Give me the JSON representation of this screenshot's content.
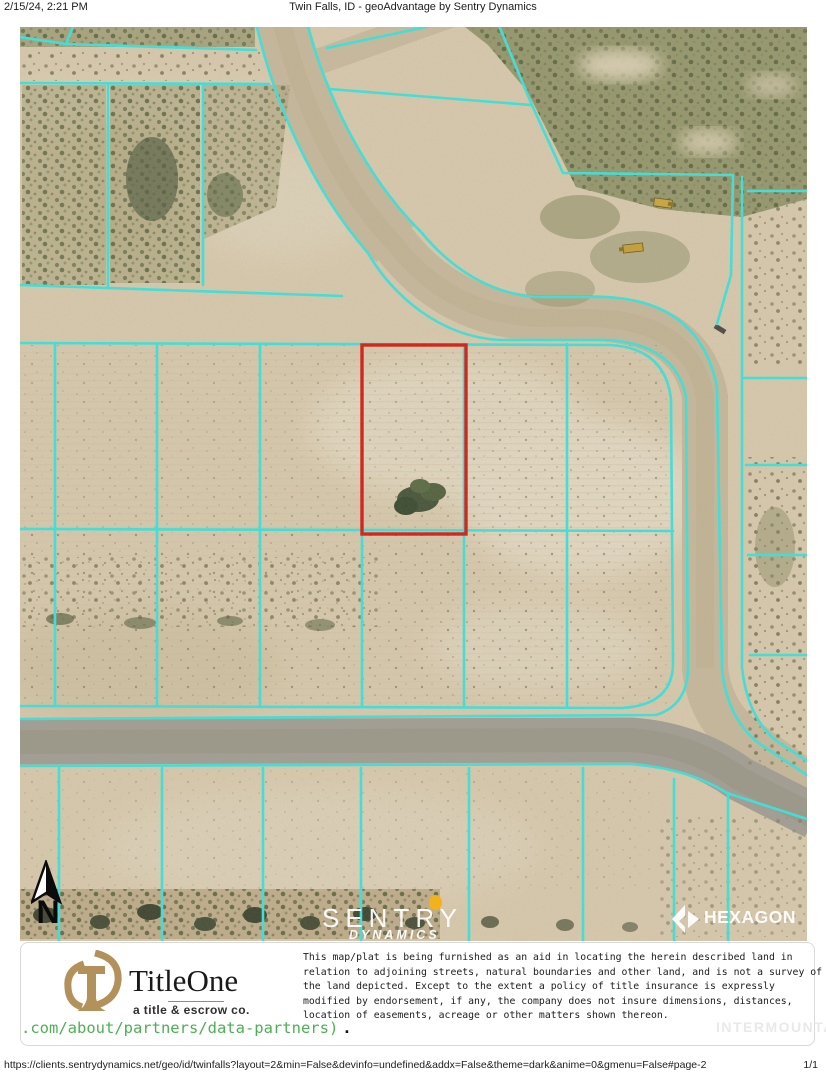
{
  "header": {
    "datetime": "2/15/24, 2:21 PM",
    "title": "Twin Falls, ID - geoAdvantage by Sentry Dynamics"
  },
  "map": {
    "type": "aerial-parcel-map",
    "highlighted_parcel": "red rectangle outline on vacant lot",
    "overlays": {
      "sentry_logo": {
        "line1": "SENTRY",
        "line2": "DYNAMICS"
      },
      "hexagon_logo": {
        "label": "HEXAGON"
      },
      "north_arrow": {
        "label": "N"
      }
    }
  },
  "colors": {
    "parcel_line": "#3BE3DC",
    "highlight": "#D41D15",
    "ground": "#D8C9AD",
    "road_gray": "#A29E94",
    "link_green": "#4DB054",
    "titleone_gold": "#B3915A",
    "sentry_dot": "#F2B21C"
  },
  "info_panel": {
    "titleone": {
      "name": "TitleOne",
      "tagline": "a title & escrow co.",
      "partial_url": ".com/about/partners/data-partners)",
      "period": "."
    },
    "disclaimer_lines": [
      "This map/plat is being furnished as an aid in locating the herein described land in",
      "relation to adjoining streets, natural boundaries and other land, and is not a survey of",
      "the land depicted. Except to the extent a policy of title insurance is expressly",
      "modified by endorsement, if any, the company does not insure dimensions, distances,",
      "location of easements, acreage or other matters shown thereon."
    ],
    "watermark": "INTERMOUNTAIN"
  },
  "footer": {
    "url": "https://clients.sentrydynamics.net/geo/id/twinfalls?layout=2&min=False&devinfo=undefined&addx=False&theme=dark&anime=0&gmenu=False#page-2",
    "page": "1/1"
  }
}
